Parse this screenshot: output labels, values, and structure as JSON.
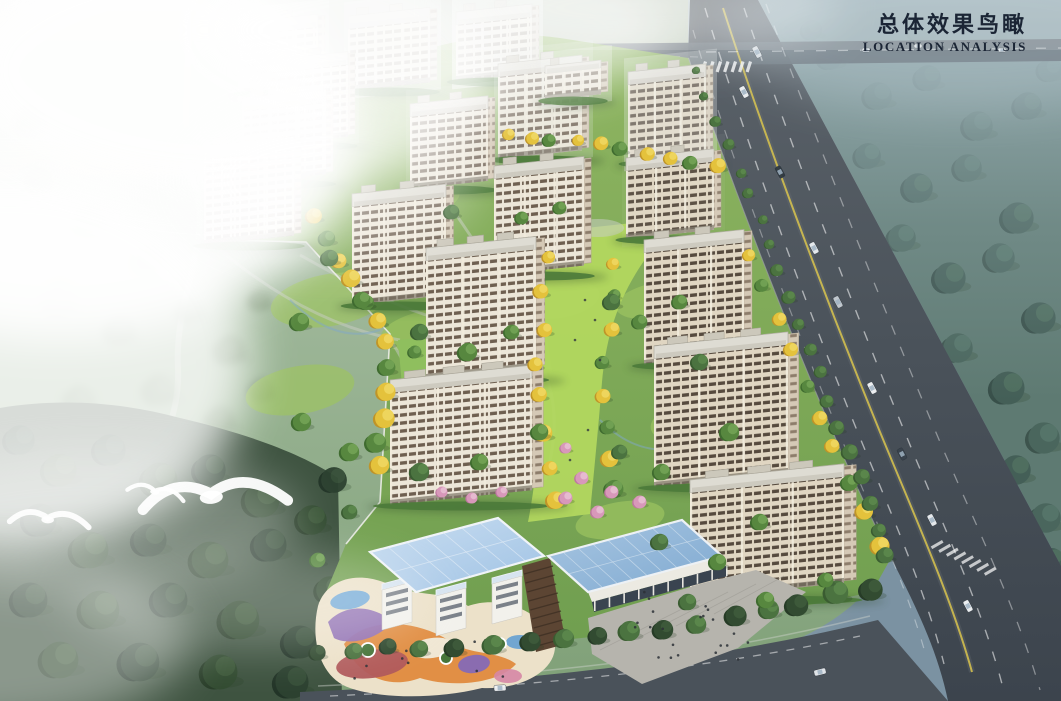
{
  "title": {
    "zh": "总体效果鸟瞰",
    "en": "LOCATION ANALYSIS",
    "text_color": "#1b2535"
  },
  "scene": {
    "type": "aerial-birdseye-architectural-rendering",
    "residential_building_count": 18,
    "birds_count": 3,
    "landmarks": [
      "residential-towers",
      "central-green-axis",
      "kindergarten-playground",
      "commercial-hall-plaza",
      "main-highway",
      "crossing-road",
      "meadow-with-fog",
      "dark-forest",
      "hazy-forest-east"
    ],
    "palette": {
      "fog_white": "#f2f4f2",
      "haze_blue": "#7e95a4",
      "site_green": "#7fae5a",
      "axis_lawn": "#b2d75f",
      "tree_green": "#4e7c3f",
      "tree_gold": "#e4c23c",
      "blossom_pink": "#d898ba",
      "road_asphalt": "#4d555c",
      "lane_yellow": "#d9c44e",
      "facade_cream": "#ece6d8",
      "window_brown": "#6e5f50",
      "glass_roof_blue": "#a8c6e2",
      "playground_orange": "#e08a3e",
      "playground_purple": "#9070b4",
      "playground_red": "#b05a5c"
    }
  }
}
